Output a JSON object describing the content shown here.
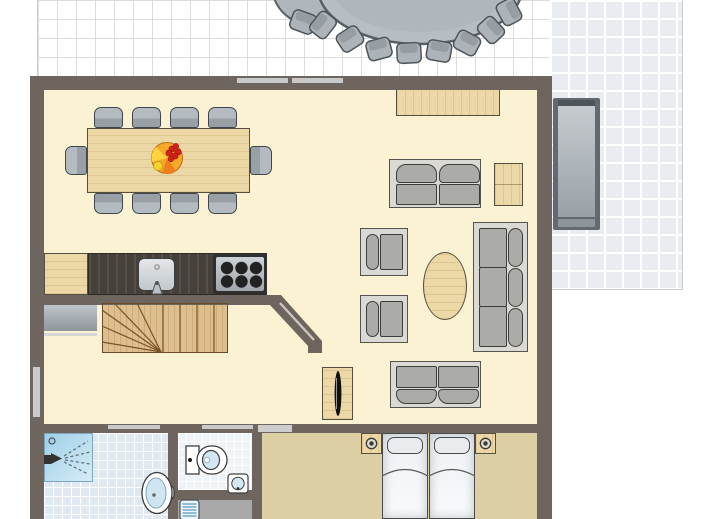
{
  "document": {
    "kind": "architectural floor plan",
    "visible_text": "none"
  },
  "colors": {
    "wall": "#6e665e",
    "floor_main": "#fbf1d3",
    "floor_bedroom": "#dccfa3",
    "tile_white": "#ffffff",
    "tile_line": "#dcdcdc",
    "tile_blue": "#e9edf2",
    "bath_tile": "#e0e8f1",
    "wc_tile": "#eef3f8",
    "entry_gray": "#a9a9a9",
    "wood": "#ecd7a7",
    "wood_border": "#564f3e",
    "counter_dark": "#46403a",
    "sofa_frame": "#dad9d4",
    "cushion": "#ababa8",
    "chair_gray": "#a8b0b6",
    "outline": "#3c3c3c",
    "glass": "#c9c9c9",
    "water": "#cfe6f2",
    "shower_blue": "#aed6ec",
    "mat_stripe": "#79aed2",
    "bed_white": "#f2f5f7",
    "stair_wood": "#ddbe8e",
    "stair_line": "#7a5228"
  },
  "rooms": [
    {
      "name": "terrace-top",
      "floor": "white tiles with gray grid"
    },
    {
      "name": "terrace-right",
      "floor": "blue-gray tiles with white grid"
    },
    {
      "name": "kitchen-dining",
      "floor": "cream"
    },
    {
      "name": "living-room",
      "floor": "cream"
    },
    {
      "name": "hallway",
      "floor": "cream"
    },
    {
      "name": "bathroom",
      "floor": "light blue tiles"
    },
    {
      "name": "wc",
      "floor": "pale tiles"
    },
    {
      "name": "entrance",
      "floor": "gray"
    },
    {
      "name": "bedroom",
      "floor": "tan"
    }
  ],
  "furniture": {
    "terrace_top": [
      "large oval dining table",
      "10 outdoor chairs (partially cropped)",
      "small round table (cropped)"
    ],
    "terrace_right": [
      "sun lounger"
    ],
    "dining": [
      "rectangular wooden table",
      "10 gray chairs",
      "fruit bowl"
    ],
    "kitchen": [
      "wooden base cabinet",
      "dark worktop",
      "sink with tap",
      "stove with 6 burners"
    ],
    "hallway": [
      "gray dresser",
      "winding staircase"
    ],
    "living": [
      "wooden sideboard",
      "two-seat sofa (top)",
      "wooden side cabinet",
      "two armchairs",
      "oval wooden coffee table",
      "three-seat sofa",
      "two-seat sofa (bottom)",
      "wooden TV cabinet with TV"
    ],
    "bathroom": [
      "corner shower with spray",
      "oval washbasin with tap"
    ],
    "wc": [
      "toilet with cistern",
      "small corner washbasin"
    ],
    "bedroom": [
      "double bed with two mattresses and pillows",
      "two nightstands with lamps"
    ],
    "entrance": [
      "striped doormat"
    ]
  },
  "fixtures": {
    "terrace_door_panes": 2,
    "left_wall_window": 1,
    "interior_door_openings": 3,
    "diagonal_wall": "between kitchen and living room"
  }
}
